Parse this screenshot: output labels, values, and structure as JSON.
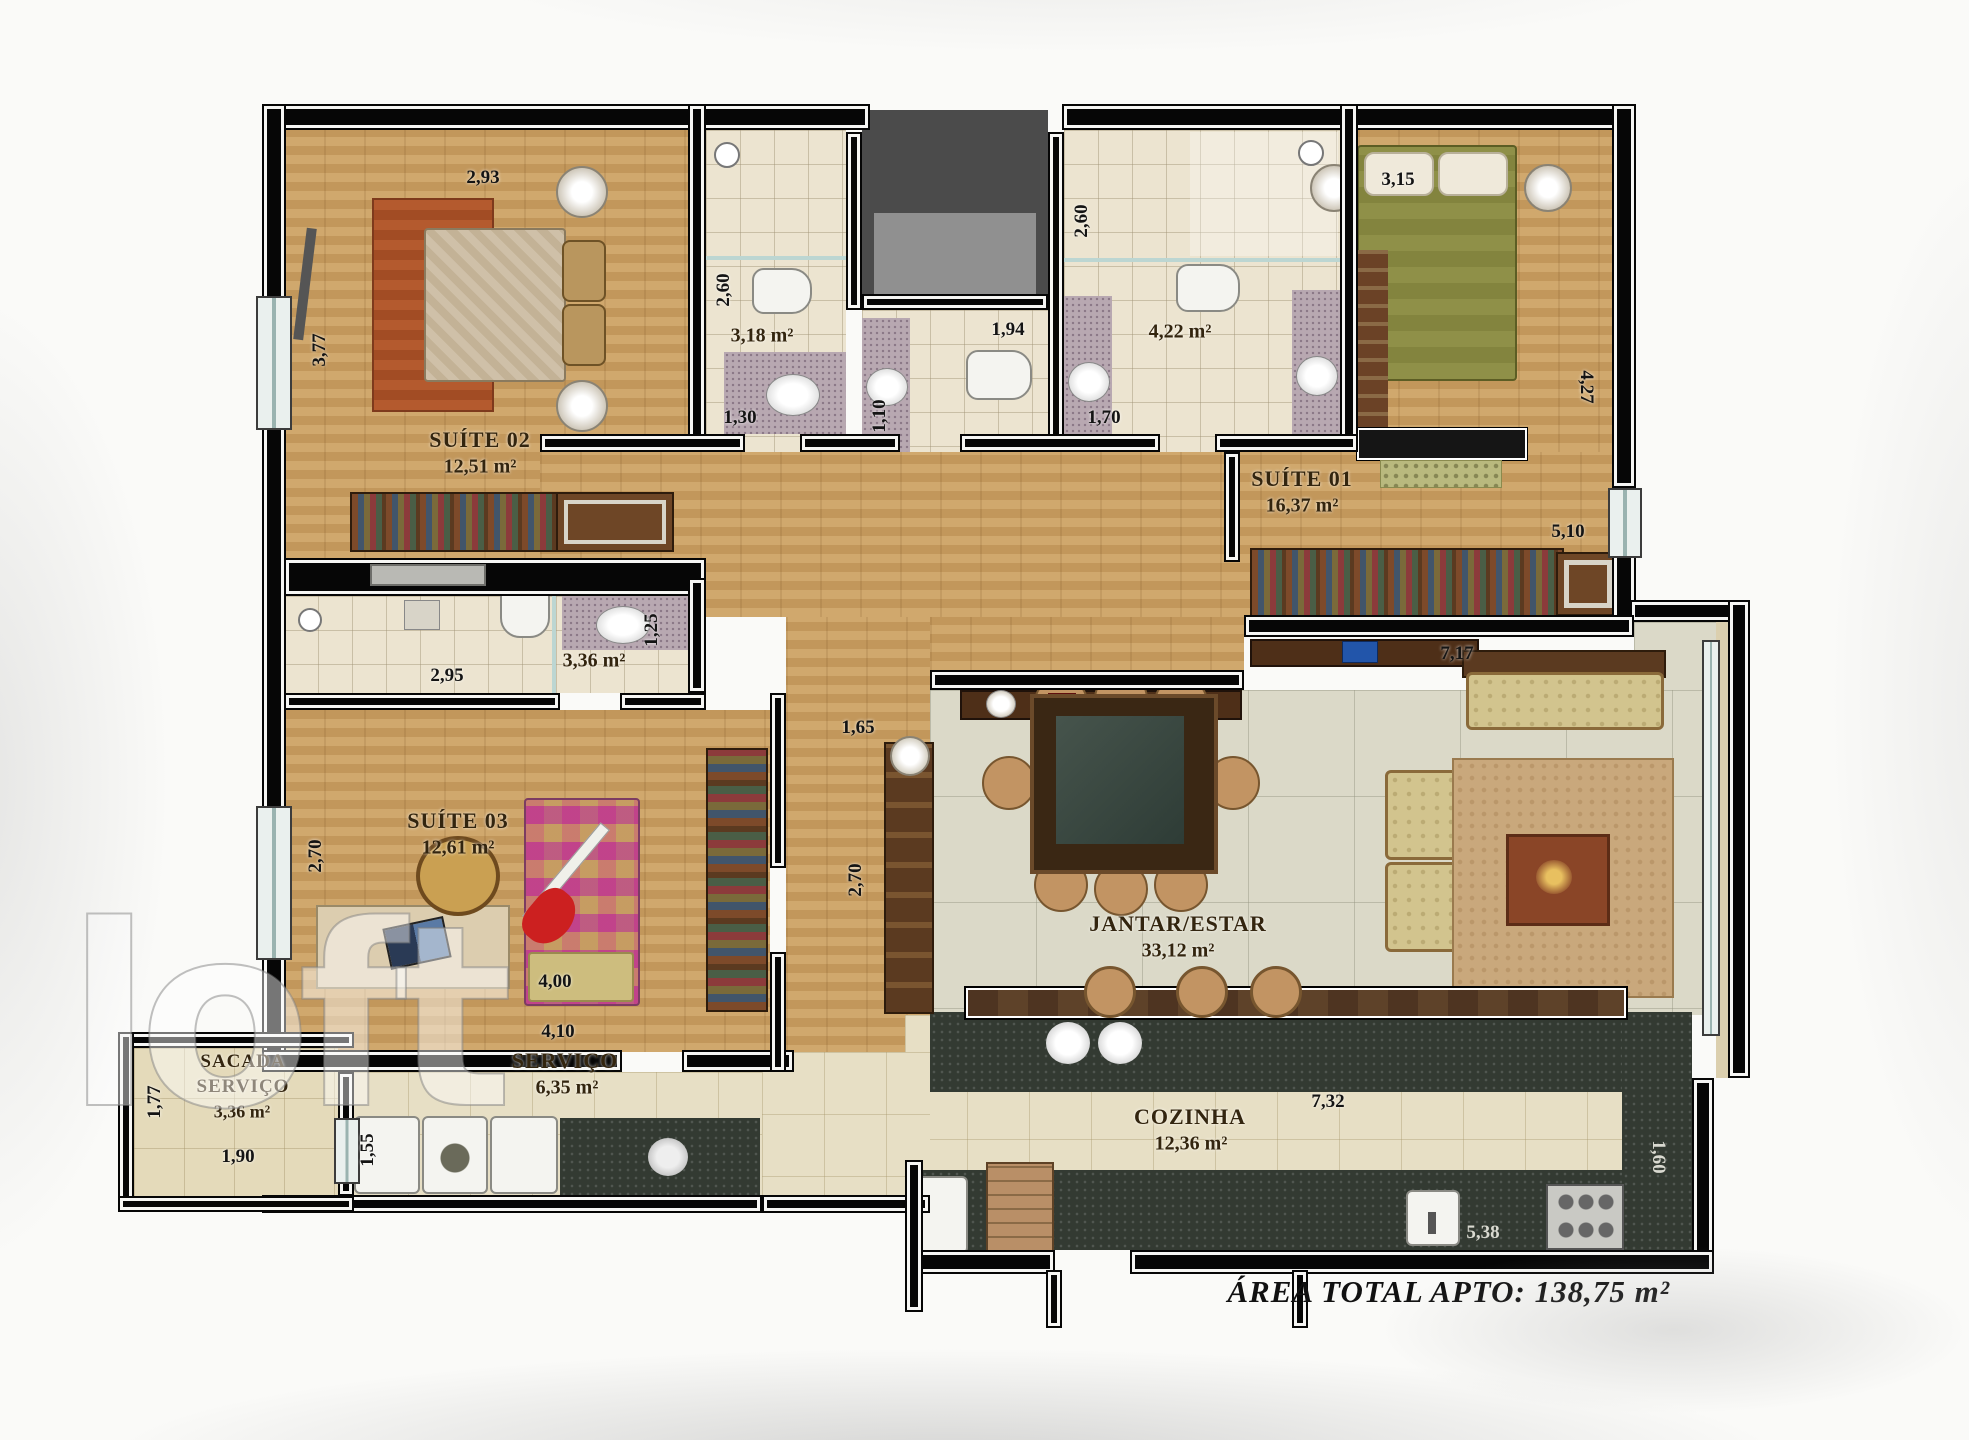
{
  "watermark": "loft",
  "footer": {
    "total_area": "ÁREA TOTAL APTO: 138,75 m²"
  },
  "rooms": {
    "suite02": {
      "name": "SUÍTE 02",
      "area": "12,51 m²"
    },
    "suite01": {
      "name": "SUÍTE 01",
      "area": "16,37 m²"
    },
    "suite03": {
      "name": "SUÍTE 03",
      "area": "12,61 m²"
    },
    "living": {
      "name": "JANTAR/ESTAR",
      "area": "33,12 m²"
    },
    "kitchen": {
      "name": "COZINHA",
      "area": "12,36 m²"
    },
    "servico": {
      "name": "SERVIÇO",
      "area": "6,35 m²"
    },
    "sacada": {
      "name": "SACADA\nSERVIÇO",
      "area": "3,36 m²"
    },
    "bath_suite02": {
      "area": "3,18 m²"
    },
    "bath_suite01": {
      "area": "4,22 m²"
    },
    "bath_suite03": {
      "area": "3,36 m²"
    }
  },
  "dimensions": {
    "suite02_width": "2,93",
    "suite02_depth": "3,77",
    "bath02_depth": "2,60",
    "bath02_width": "1,30",
    "lavabo_width": "1,10",
    "lavabo_depth": "1,94",
    "bath01_depth": "2,60",
    "bath01_width": "1,70",
    "suite01_entry": "3,15",
    "suite01_depth": "4,27",
    "suite01_closet": "5,10",
    "living_width": "7,17",
    "living_depth": "4,26",
    "bath03_width": "2,95",
    "bath03_depth": "1,25",
    "suite03_depth": "2,70",
    "suite03_width": "4,00",
    "hall_width": "1,65",
    "hall_depth": "2,70",
    "servico_width": "4,10",
    "servico_entry": "1,55",
    "sacada_depth": "1,77",
    "sacada_width": "1,90",
    "kitchen_width": "7,32",
    "kitchen_counter": "5,38",
    "kitchen_depth": "1,60"
  }
}
